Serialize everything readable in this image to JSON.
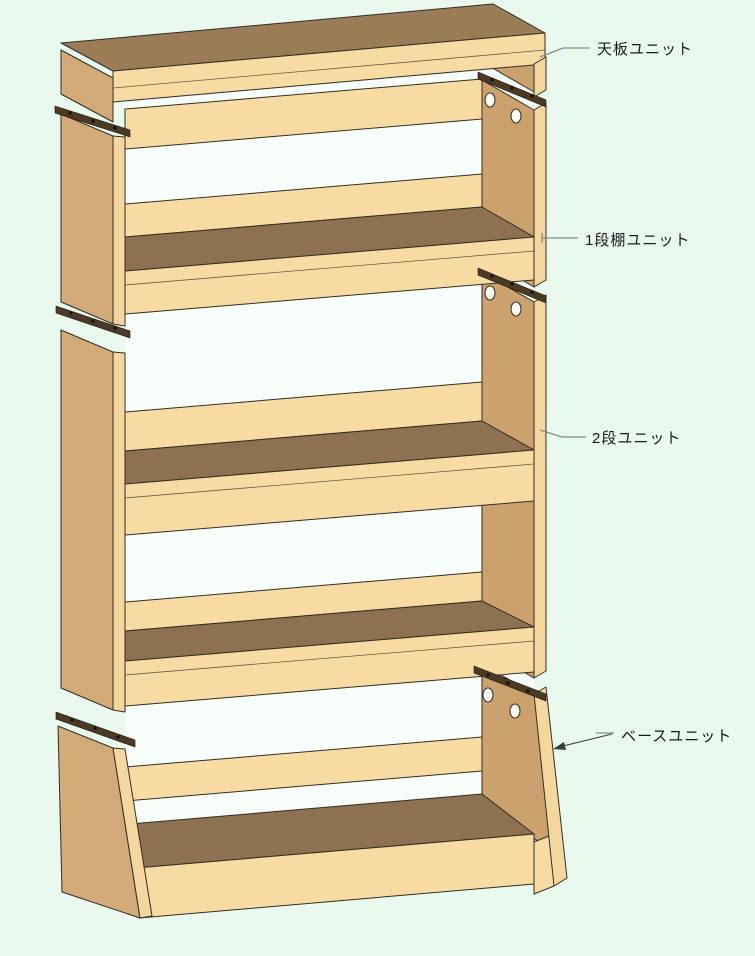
{
  "canvas": {
    "width": 755,
    "height": 956,
    "background": "#e9f9ee"
  },
  "diagram": {
    "type": "furniture-assembly-diagram",
    "subject": "Stacked modular wooden shelf: top board unit, one-tier shelf unit, two-tier unit and base unit shown in 3D perspective with joining cleats and screw holes",
    "labels": {
      "top_unit": "天板ユニット",
      "tier1_unit": "1段棚ユニット",
      "tier2_unit": "2段ユニット",
      "base_unit": "ベースユニット"
    },
    "palette": {
      "background": "#e9f9ee",
      "interior": "#f7fdf8",
      "wood_light": "#f7dba3",
      "wood_strip": "#f4d79e",
      "wood_medium": "#d3ab78",
      "wood_inner": "#cba26e",
      "wood_top": "#9a7c57",
      "shelf_top": "#8e7150",
      "outline": "#332d24",
      "cleat": "#4b3a24",
      "leader": "#888888",
      "text": "#1a1a1a"
    }
  }
}
